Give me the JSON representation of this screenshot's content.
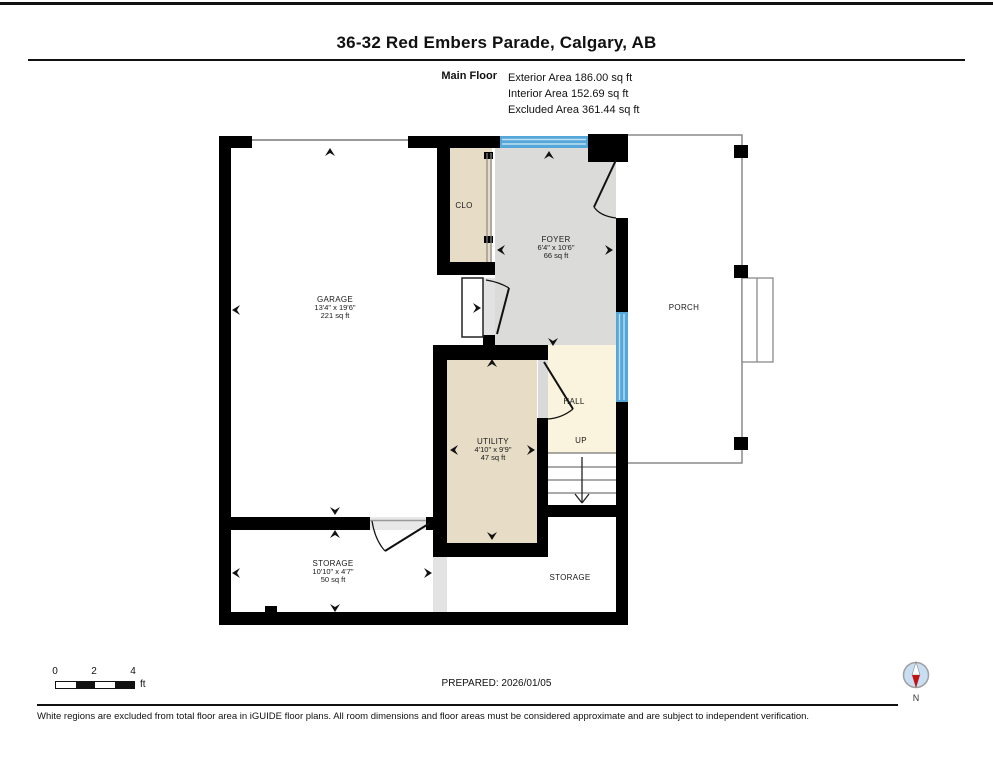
{
  "header": {
    "title": "36-32 Red Embers Parade, Calgary, AB",
    "floor_label": "Main Floor",
    "stats": [
      "Exterior Area 186.00 sq ft",
      "Interior Area 152.69 sq ft",
      "Excluded Area 361.44 sq ft"
    ]
  },
  "rooms": {
    "garage": {
      "name": "GARAGE",
      "dims": "13'4\" x 19'6\"",
      "area": "221 sq ft"
    },
    "clo": {
      "name": "CLO"
    },
    "foyer": {
      "name": "FOYER",
      "dims": "6'4\" x 10'6\"",
      "area": "66 sq ft"
    },
    "porch": {
      "name": "PORCH"
    },
    "hall": {
      "name": "HALL"
    },
    "stairs": {
      "label": "UP"
    },
    "utility": {
      "name": "UTILITY",
      "dims": "4'10\" x 9'9\"",
      "area": "47 sq ft"
    },
    "storage_left": {
      "name": "STORAGE",
      "dims": "10'10\" x 4'7\"",
      "area": "50 sq ft"
    },
    "storage_right": {
      "name": "STORAGE"
    }
  },
  "footer": {
    "scale_ticks": [
      "0",
      "2",
      "4"
    ],
    "scale_unit": "ft",
    "prepared": "PREPARED: 2026/01/05",
    "compass_label": "N",
    "disclaimer": "White regions are excluded from total floor area in iGUIDE floor plans. All room dimensions and floor areas must be considered approximate and are subject to independent verification."
  },
  "colors": {
    "wall": "#000000",
    "room_gray": "#dbdbd9",
    "room_beige": "#e7dcc6",
    "room_cream": "#faf3dd",
    "window_blue": "#55a6d9",
    "compass_red": "#c11414"
  }
}
